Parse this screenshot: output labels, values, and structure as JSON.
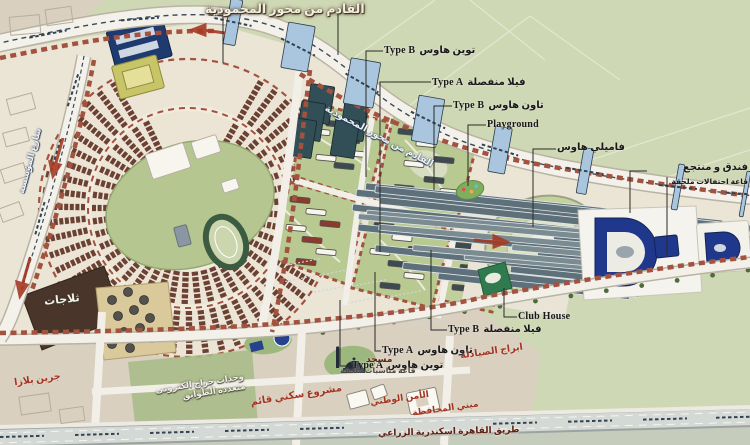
{
  "title_top": "القادم من محور المحمودية",
  "roads": {
    "diagonal": "القادم من محور المحمودية",
    "left": "شارع المؤسسة",
    "bottom": "طريق القاهرة اسكندرية الزراعي"
  },
  "callouts": {
    "twin_house_b": {
      "en": "Type B",
      "ar": "توين هاوس"
    },
    "villa_a": {
      "en": "Type A",
      "ar": "فيلا منفصلة"
    },
    "town_house_b": {
      "en": "Type B",
      "ar": "تاون هاوس"
    },
    "playground": {
      "en": "Playground"
    },
    "family_house": {
      "ar": "فاميلي هاوس"
    },
    "hotel": {
      "ar": "فندق و منتجع",
      "sub": "قاعة احتفالات ملحقة"
    },
    "club_house": {
      "en": "Club House"
    },
    "villa_b": {
      "en": "Type B",
      "ar": "فيلا منفصلة"
    },
    "town_house_a": {
      "en": "Type A",
      "ar": "تاون هاوس"
    },
    "twin_house_a": {
      "en": "Type A",
      "ar": "توين هاوس"
    },
    "mosque": {
      "ar": "مسجد",
      "sub": "قاعة مناسبات ملحقة"
    },
    "garage": {
      "line1": "وحدات جراج الكترونى",
      "line2": "متعددة الطوابق"
    },
    "residential_project": {
      "ar": "مشروع سكني قائم"
    },
    "national_security": {
      "ar": "الأمن الوطني"
    },
    "governorate": {
      "ar": "مبني المحافظة"
    },
    "pharmacists_towers": {
      "ar": "ابراج الصيادلة"
    },
    "green_plaza": {
      "ar": "جرين بلازا"
    },
    "cold_storage": {
      "ar": "ثلاجات"
    }
  },
  "colors": {
    "field_green": "#cfd8b4",
    "park_green": "#b8c992",
    "plan_cream": "#ebe5d6",
    "zone_beige": "#d9d0c0",
    "building_brown": "#6b4133",
    "row_red": "#a3523f",
    "tram_blue": "#a9c6de",
    "landmark_navy": "#20388c",
    "teal_block": "#324e56",
    "label_red": "#a33420"
  }
}
